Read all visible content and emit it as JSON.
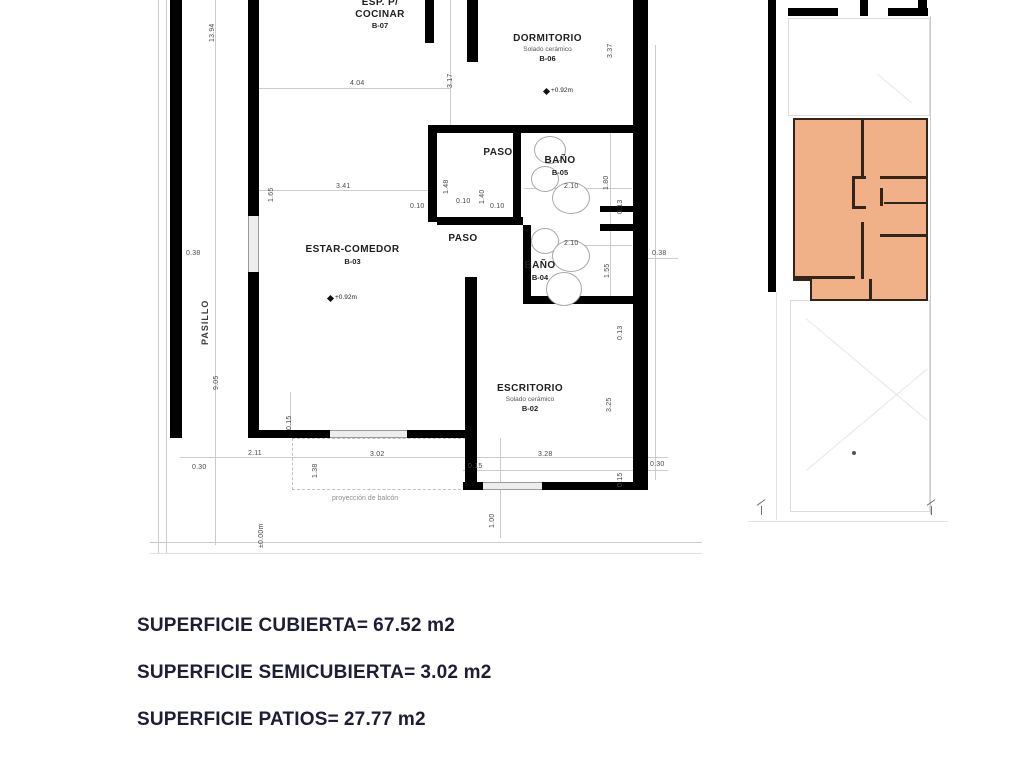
{
  "colors": {
    "wall": "#000000",
    "highlight_fill": "#f0b189",
    "highlight_wall": "#34251a",
    "summary_text": "#1d1d33",
    "dimension_text": "#4a4a4a"
  },
  "floor_plan": {
    "rooms": {
      "kitchen": {
        "name_line1": "ESP. P/",
        "name_line2": "COCINAR",
        "code": "B-07"
      },
      "dormitorio": {
        "name": "DORMITORIO",
        "floor_finish": "Solado cerámico",
        "code": "B-06",
        "level": "+0.92m"
      },
      "paso_upper": {
        "name": "PASO"
      },
      "bano_05": {
        "name": "BAÑO",
        "code": "B-05"
      },
      "paso_lower": {
        "name": "PASO"
      },
      "bano_04": {
        "name": "BAÑO",
        "code": "B-04"
      },
      "estar": {
        "name": "ESTAR-COMEDOR",
        "code": "B-03",
        "level": "+0.92m"
      },
      "escritorio": {
        "name": "ESCRITORIO",
        "floor_finish": "Solado cerámico",
        "code": "B-02"
      },
      "pasillo": {
        "name": "PASILLO"
      }
    },
    "dimensions": [
      {
        "text": "13.94",
        "x": 209,
        "y": 42,
        "o": "v"
      },
      {
        "text": "0.38",
        "x": 186,
        "y": 250,
        "o": "h"
      },
      {
        "text": "9.05",
        "x": 213,
        "y": 390,
        "o": "v"
      },
      {
        "text": "0.30",
        "x": 192,
        "y": 464,
        "o": "h"
      },
      {
        "text": "4.04",
        "x": 350,
        "y": 80,
        "o": "h"
      },
      {
        "text": "3.17",
        "x": 447,
        "y": 88,
        "o": "v"
      },
      {
        "text": "3.37",
        "x": 607,
        "y": 58,
        "o": "v"
      },
      {
        "text": "3.41",
        "x": 336,
        "y": 183,
        "o": "h"
      },
      {
        "text": "1.65",
        "x": 268,
        "y": 202,
        "o": "v"
      },
      {
        "text": "1.48",
        "x": 443,
        "y": 194,
        "o": "v"
      },
      {
        "text": "1.40",
        "x": 479,
        "y": 204,
        "o": "v"
      },
      {
        "text": "0.10",
        "x": 410,
        "y": 203,
        "o": "h"
      },
      {
        "text": "0.10",
        "x": 456,
        "y": 198,
        "o": "h"
      },
      {
        "text": "0.10",
        "x": 490,
        "y": 203,
        "o": "h"
      },
      {
        "text": "2.10",
        "x": 564,
        "y": 183,
        "o": "h"
      },
      {
        "text": "1.80",
        "x": 603,
        "y": 190,
        "o": "v"
      },
      {
        "text": "0.13",
        "x": 617,
        "y": 214,
        "o": "v"
      },
      {
        "text": "0.38",
        "x": 652,
        "y": 250,
        "o": "h"
      },
      {
        "text": "2.10",
        "x": 564,
        "y": 240,
        "o": "h"
      },
      {
        "text": "1.55",
        "x": 604,
        "y": 278,
        "o": "v"
      },
      {
        "text": "0.13",
        "x": 617,
        "y": 340,
        "o": "v"
      },
      {
        "text": "0.15",
        "x": 286,
        "y": 430,
        "o": "v"
      },
      {
        "text": "3.25",
        "x": 606,
        "y": 412,
        "o": "v"
      },
      {
        "text": "2.11",
        "x": 248,
        "y": 450,
        "o": "h"
      },
      {
        "text": "1.38",
        "x": 312,
        "y": 478,
        "o": "v"
      },
      {
        "text": "3.02",
        "x": 370,
        "y": 451,
        "o": "h"
      },
      {
        "text": "0.15",
        "x": 468,
        "y": 463,
        "o": "h"
      },
      {
        "text": "3.28",
        "x": 538,
        "y": 451,
        "o": "h"
      },
      {
        "text": "0.15",
        "x": 617,
        "y": 487,
        "o": "v"
      },
      {
        "text": "0.30",
        "x": 650,
        "y": 461,
        "o": "h"
      },
      {
        "text": "1.00",
        "x": 489,
        "y": 528,
        "o": "v"
      },
      {
        "text": "±0.00m",
        "x": 258,
        "y": 548,
        "o": "v"
      }
    ],
    "annotations": [
      {
        "text": "proyección de balcón",
        "x": 332,
        "y": 495
      }
    ]
  },
  "summary": {
    "lines": [
      {
        "label": "SUPERFICIE CUBIERTA=",
        "value": "67.52 m2"
      },
      {
        "label": "SUPERFICIE SEMICUBIERTA=",
        "value": "3.02 m2"
      },
      {
        "label": "SUPERFICIE PATIOS=",
        "value": "27.77 m2"
      }
    ]
  }
}
